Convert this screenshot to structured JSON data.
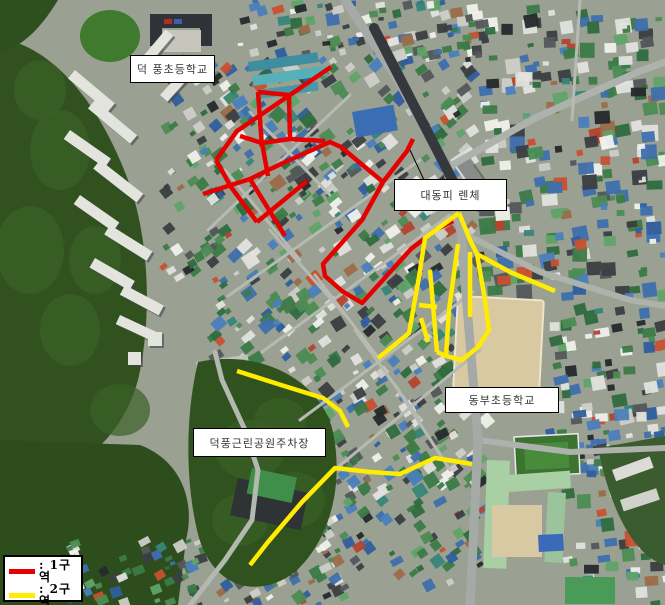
{
  "map": {
    "width": 665,
    "height": 605,
    "labels": [
      {
        "text": "덕 풍초등학교",
        "x": 130,
        "y": 55,
        "w": 85,
        "h": 28
      },
      {
        "text": "대동피 렌체",
        "x": 394,
        "y": 179,
        "w": 113,
        "h": 32,
        "pointer": [
          424,
          180,
          410,
          150
        ]
      },
      {
        "text": "동부초등학교",
        "x": 445,
        "y": 387,
        "w": 114,
        "h": 26
      },
      {
        "text": "덕풍근린공원주차장",
        "x": 193,
        "y": 428,
        "w": 133,
        "h": 29
      }
    ],
    "legend": {
      "x": 3,
      "y": 555,
      "w": 80,
      "h": 47,
      "items": [
        {
          "label": ": 1구역",
          "color": "#e60000"
        },
        {
          "label": ": 2구역",
          "color": "#ffec00"
        }
      ]
    },
    "zones": [
      {
        "name": "1구역",
        "color": "#e60000",
        "stroke_width": 4.5,
        "polylines": [
          [
            [
              331,
              67
            ],
            [
              237,
              131
            ],
            [
              216,
              160
            ]
          ],
          [
            [
              258,
              92
            ],
            [
              289,
              95
            ]
          ],
          [
            [
              258,
              92
            ],
            [
              262,
              147
            ]
          ],
          [
            [
              289,
              95
            ],
            [
              290,
              139
            ]
          ],
          [
            [
              240,
              136
            ],
            [
              262,
              143
            ],
            [
              290,
              139
            ],
            [
              325,
              141
            ]
          ],
          [
            [
              262,
              143
            ],
            [
              268,
              176
            ]
          ],
          [
            [
              203,
              194
            ],
            [
              250,
              179
            ],
            [
              283,
              163
            ],
            [
              330,
              142
            ],
            [
              341,
              147
            ],
            [
              383,
              182
            ]
          ],
          [
            [
              250,
              179
            ],
            [
              285,
              236
            ]
          ],
          [
            [
              383,
              182
            ],
            [
              407,
              151
            ],
            [
              413,
              139
            ]
          ],
          [
            [
              383,
              182
            ],
            [
              362,
              220
            ],
            [
              323,
              264
            ],
            [
              325,
              276
            ],
            [
              342,
              291
            ],
            [
              362,
              303
            ],
            [
              411,
              249
            ],
            [
              437,
              229
            ],
            [
              453,
              221
            ]
          ],
          [
            [
              216,
              160
            ],
            [
              231,
              187
            ],
            [
              257,
              222
            ]
          ],
          [
            [
              257,
              222
            ],
            [
              307,
              181
            ]
          ]
        ]
      },
      {
        "name": "2구역",
        "color": "#ffec00",
        "stroke_width": 4.5,
        "polylines": [
          [
            [
              459,
              213
            ],
            [
              425,
              238
            ],
            [
              419,
              277
            ],
            [
              409,
              333
            ],
            [
              392,
              347
            ],
            [
              378,
              358
            ]
          ],
          [
            [
              459,
              213
            ],
            [
              470,
              240
            ],
            [
              477,
              254
            ],
            [
              510,
              272
            ],
            [
              555,
              291
            ]
          ],
          [
            [
              477,
              254
            ],
            [
              485,
              300
            ],
            [
              489,
              330
            ],
            [
              478,
              347
            ],
            [
              462,
              360
            ],
            [
              446,
              356
            ],
            [
              437,
              352
            ]
          ],
          [
            [
              430,
              270
            ],
            [
              437,
              352
            ]
          ],
          [
            [
              458,
              244
            ],
            [
              449,
              310
            ],
            [
              446,
              356
            ]
          ],
          [
            [
              470,
              252
            ],
            [
              470,
              317
            ]
          ],
          [
            [
              419,
              305
            ],
            [
              437,
              307
            ]
          ],
          [
            [
              421,
              318
            ],
            [
              428,
              342
            ]
          ],
          [
            [
              237,
              371
            ],
            [
              281,
              385
            ],
            [
              323,
              398
            ],
            [
              340,
              411
            ],
            [
              348,
              427
            ]
          ],
          [
            [
              472,
              464
            ],
            [
              435,
              458
            ],
            [
              400,
              474
            ],
            [
              370,
              472
            ],
            [
              335,
              468
            ],
            [
              302,
              502
            ],
            [
              268,
              542
            ],
            [
              250,
              565
            ]
          ]
        ]
      }
    ]
  }
}
